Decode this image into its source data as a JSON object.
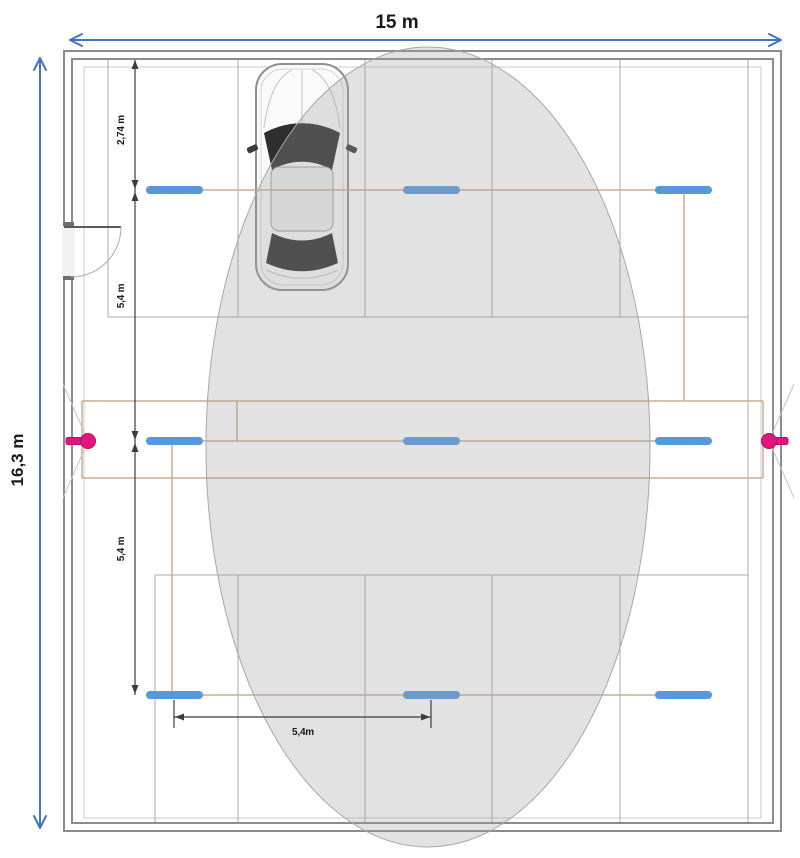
{
  "plan": {
    "width_label": "15 m",
    "height_label": "16,3 m",
    "offset_top_label": "2,74 m",
    "row_spacing_label_upper": "5,4 m",
    "row_spacing_label_lower": "5,4 m",
    "column_spacing_label": "5,4m",
    "luminaire_rows": 3,
    "luminaire_columns": 3,
    "luminaire_count": 9,
    "sensor_count": 2,
    "parked_car_count": 1
  },
  "colors": {
    "luminaire": "#5598DE",
    "arrow": "#4472C4",
    "wiring": "#C9AE92",
    "sensor": "#E0157E",
    "sensor_stroke": "#B80D63",
    "zone_fill": "rgba(158,158,158,0.30)",
    "zone_stroke": "#A8A8A8",
    "wall": "#8C8C8C",
    "floor": "#EDEDED"
  }
}
